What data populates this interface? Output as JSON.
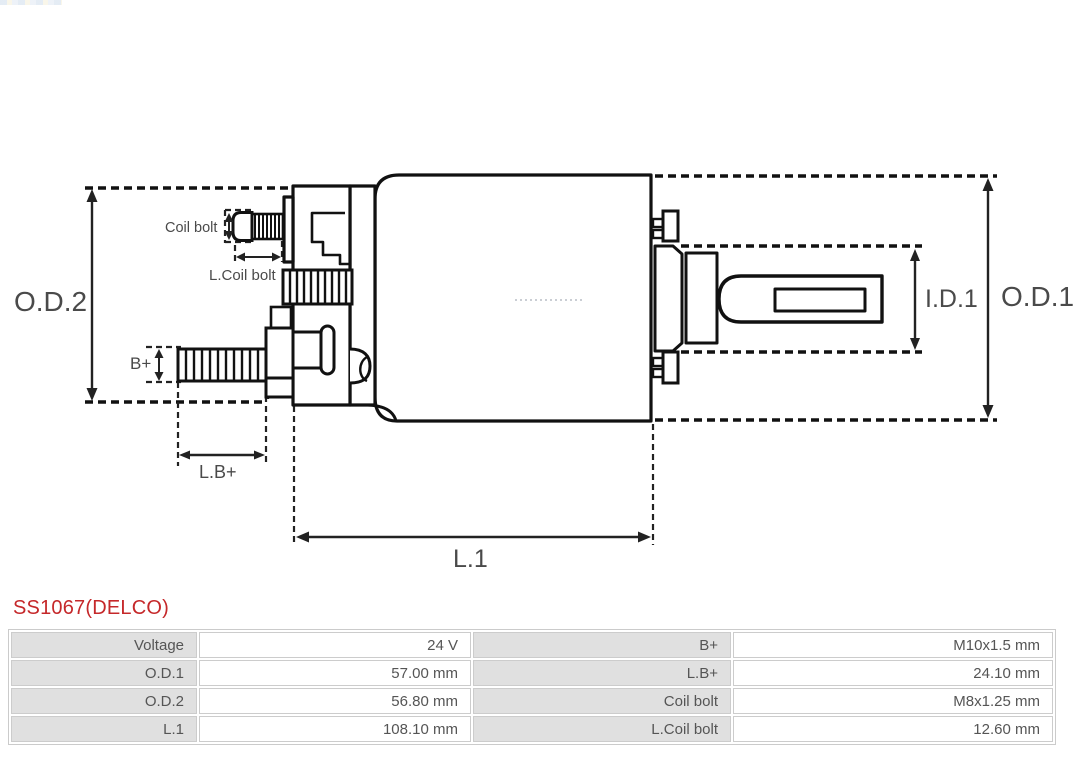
{
  "product": {
    "title": "SS1067(DELCO)"
  },
  "colors": {
    "title_red": "#c5282a",
    "table_label_bg": "#e0e0e0",
    "table_border": "#cccccc",
    "drawing_line": "#111111",
    "dimension_line": "#222222"
  },
  "diagram": {
    "type": "technical-drawing-solenoid-side-view",
    "labels": {
      "od2": "O.D.2",
      "od1": "O.D.1",
      "id1": "I.D.1",
      "l1": "L.1",
      "lb": "L.B+",
      "b": "B+",
      "coil_bolt": "Coil bolt",
      "l_coil_bolt": "L.Coil bolt"
    }
  },
  "spec_table": {
    "rows": [
      {
        "c0_label": "Voltage",
        "c0_value": "24 V",
        "c1_label": "B+",
        "c1_value": "M10x1.5 mm"
      },
      {
        "c0_label": "O.D.1",
        "c0_value": "57.00 mm",
        "c1_label": "L.B+",
        "c1_value": "24.10 mm"
      },
      {
        "c0_label": "O.D.2",
        "c0_value": "56.80 mm",
        "c1_label": "Coil bolt",
        "c1_value": "M8x1.25 mm"
      },
      {
        "c0_label": "L.1",
        "c0_value": "108.10 mm",
        "c1_label": "L.Coil bolt",
        "c1_value": "12.60 mm"
      }
    ]
  }
}
